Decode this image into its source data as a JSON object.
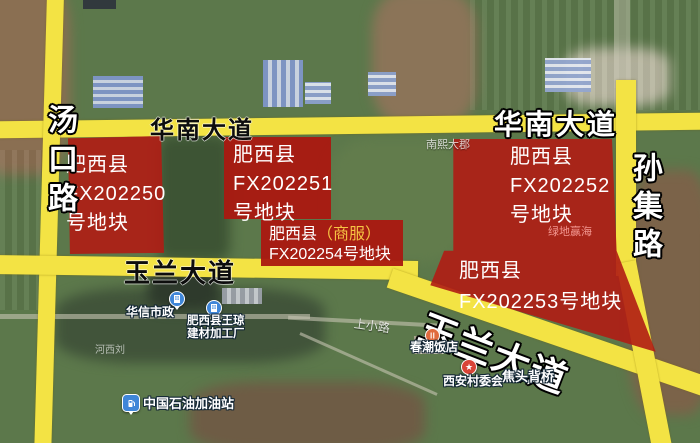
{
  "map": {
    "road_labels": {
      "huanan_left": "华南大道",
      "huanan_right": "华南大道",
      "tangkou": "汤口路",
      "sunji": "孙集路",
      "yulan_left": "玉兰大道",
      "yulan_diagonal": "玉兰大道"
    },
    "parcels": {
      "fx202250": {
        "line1": "肥西县",
        "line2": "FX202250",
        "line3": "号地块"
      },
      "fx202251": {
        "line1": "肥西县",
        "line2": "FX202251",
        "line3": "号地块"
      },
      "fx202252": {
        "line1": "肥西县",
        "line2": "FX202252",
        "line3": "号地块"
      },
      "fx202253": {
        "line1": "肥西县",
        "line2": "FX202253号地块"
      },
      "fx202254": {
        "line1_white": "肥西县",
        "line1_gold": "（商服）",
        "line2": "FX202254号地块"
      }
    },
    "pois": {
      "huaxin": {
        "label": "华信市政"
      },
      "wangqiong": {
        "line1": "肥西县王琼",
        "line2": "建材加工厂"
      },
      "gas_station": {
        "label": "中国石油加油站"
      },
      "chunchao": {
        "label": "春潮饭店"
      },
      "xian_committee": {
        "label": "西安村委会"
      },
      "jiaotou_bridge": {
        "label": "焦头背桥"
      }
    },
    "small_labels": {
      "nanxi": "南熙大郡",
      "lvdi": "绿地赢海",
      "shangxiao": "上小路",
      "hexiliu": "河西刘"
    },
    "colors": {
      "road_yellow": "#f3e344",
      "parcel_red": "#b01c14",
      "label_gold": "#f6c343",
      "marker_blue": "#3f86d8",
      "marker_red": "#d94437",
      "marker_orange": "#e06a3e"
    }
  }
}
